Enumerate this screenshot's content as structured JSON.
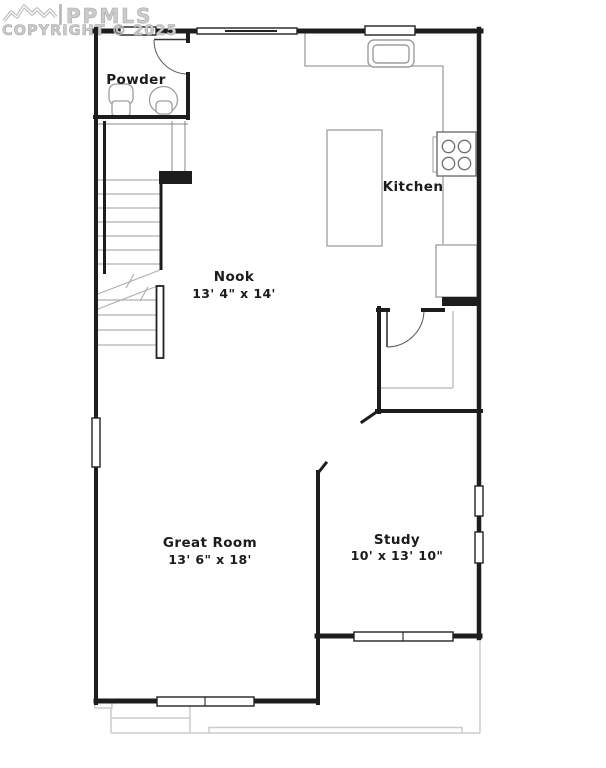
{
  "watermark": {
    "logo": "mountain-ridge-icon",
    "brand": "PPMLS",
    "copyright": "COPYRIGHT © 2025"
  },
  "floor_plan": {
    "rooms": [
      {
        "name": "Powder",
        "dimensions": ""
      },
      {
        "name": "Kitchen",
        "dimensions": ""
      },
      {
        "name": "Nook",
        "dimensions": "13' 4\" x 14'"
      },
      {
        "name": "Great Room",
        "dimensions": "13' 6\" x 18'"
      },
      {
        "name": "Study",
        "dimensions": "10' x 13' 10\""
      }
    ],
    "fixtures": [
      "pedestal-sink-icon",
      "toilet-icon",
      "staircase-icon",
      "kitchen-sink-icon",
      "cooktop-icon",
      "refrigerator-icon",
      "kitchen-island-icon",
      "pantry-shelves-icon",
      "door-swing-icon"
    ],
    "colors": {
      "wall": "#1d1d1d",
      "fixture": "#9d9d9d",
      "stair_tread": "#b0b0b0",
      "patio": "#cbcbcb",
      "watermark": "#c4c4c4",
      "background": "#ffffff"
    }
  }
}
